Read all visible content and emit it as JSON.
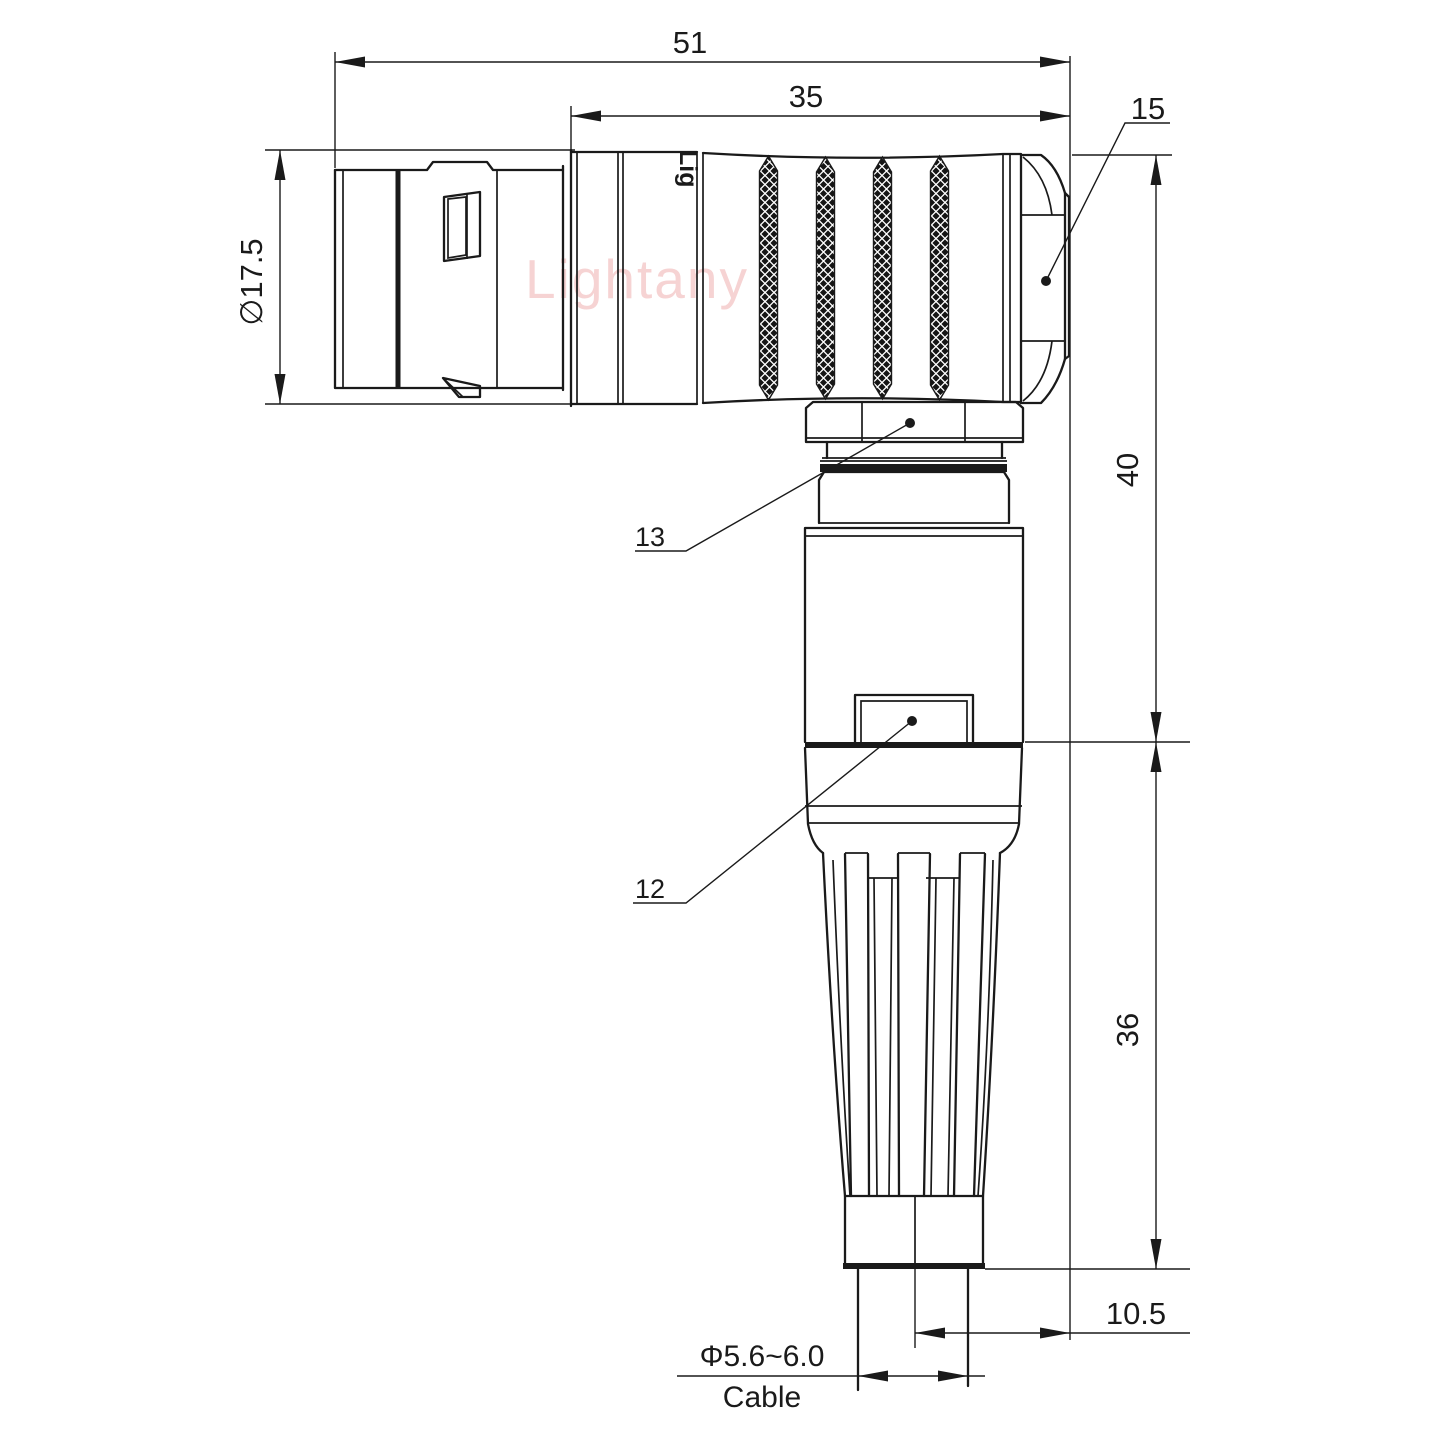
{
  "watermark": {
    "brand": "Lightany",
    "engraving": "Lig"
  },
  "dims": {
    "overall_length": "51",
    "body_length": "35",
    "hex_nut_ref": "15",
    "shell_diameter": "∅17.5",
    "height_upper": "40",
    "height_lower": "36",
    "cable_offset": "10.5",
    "cable_diameter": "Φ5.6~6.0",
    "cable_label": "Cable"
  },
  "labels": {
    "coupling_nut": "13",
    "strain_relief_body": "12"
  }
}
